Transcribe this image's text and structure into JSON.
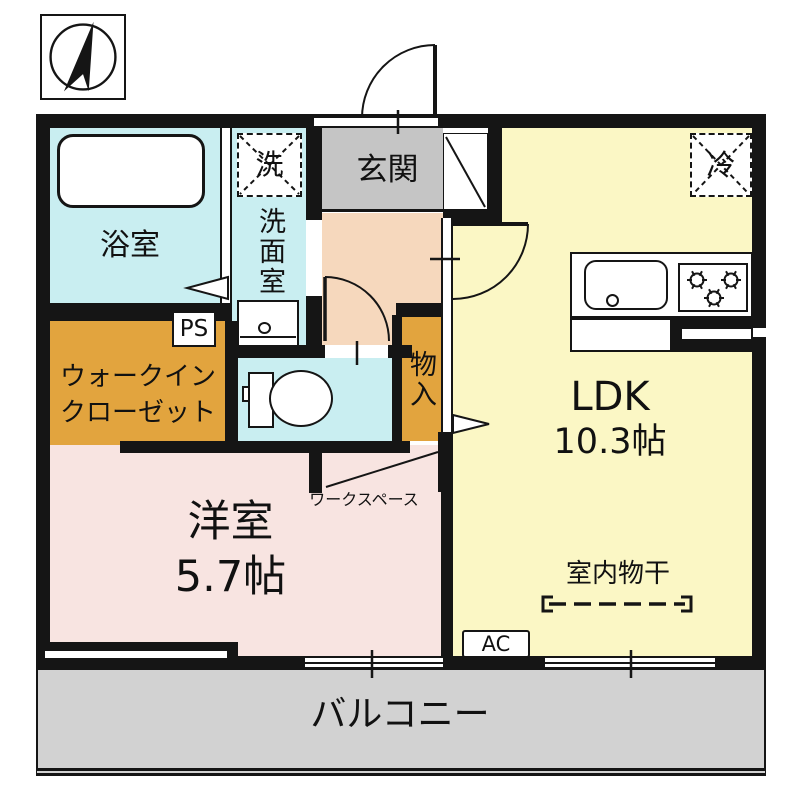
{
  "rooms": {
    "bathroom": {
      "label": "浴室"
    },
    "washroom": {
      "label": "洗面室",
      "washer_symbol": "洗"
    },
    "toilet": {},
    "entrance": {
      "label": "玄関"
    },
    "hall": {},
    "ldk": {
      "label": "LDK",
      "size": "10.3帖",
      "refrigerator_symbol": "冷",
      "indoor_drying_label": "室内物干",
      "ac_label": "AC"
    },
    "wic": {
      "label_line1": "ウォークイン",
      "label_line2": "クローゼット"
    },
    "storage": {
      "label": "物入"
    },
    "workspace": {
      "label": "ワークスペース"
    },
    "western_room": {
      "label": "洋室",
      "size": "5.7帖"
    },
    "balcony": {
      "label": "バルコニー"
    }
  },
  "labels": {
    "ps": "PS"
  },
  "icons": {
    "compass": "north-arrow-icon",
    "bathtub": "bathtub-icon",
    "toilet": "toilet-icon",
    "sink": "kitchen-sink-icon",
    "stove": "gas-stove-icon",
    "doors": "door-swing-arc",
    "drying": "indoor-drying-rod-icon"
  },
  "colors": {
    "wet_area_cyan": "#c9eef1",
    "entrance_gray": "#c5c5c5",
    "hall_peach": "#f6d8bd",
    "ldk_yellow": "#fbf7c5",
    "closet_orange": "#e2a43e",
    "bedroom_pink": "#f8e4e1",
    "balcony_gray": "#d2d2d2",
    "wall_black": "#151515"
  }
}
